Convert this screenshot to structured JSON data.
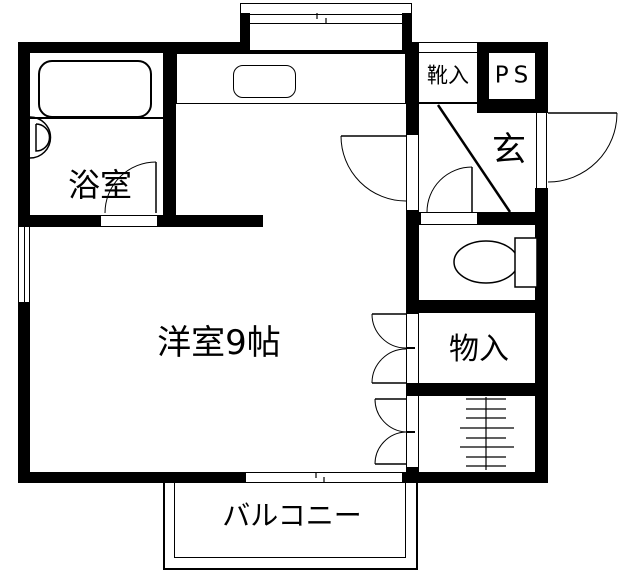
{
  "type": "floor-plan",
  "colors": {
    "wall": "#000000",
    "background": "#ffffff",
    "line": "#000000"
  },
  "rooms": {
    "bathroom": {
      "label": "浴室"
    },
    "main_room": {
      "label": "洋室9帖"
    },
    "entrance": {
      "label": "玄"
    },
    "shoe_cabinet": {
      "label": "靴入"
    },
    "pipe_space": {
      "label": "PS"
    },
    "storage": {
      "label": "物入"
    },
    "balcony": {
      "label": "バルコニー"
    }
  },
  "fixtures": [
    "bathtub",
    "washbasin",
    "bathroom-door",
    "kitchen-counter",
    "kitchen-sink",
    "sliding-window-top",
    "side-window-left",
    "sliding-window-bottom",
    "hall-door",
    "entrance-door",
    "genkan-step-diagonal",
    "toilet-door",
    "toilet-bowl",
    "toilet-tank",
    "storage-double-door",
    "closet-double-door",
    "ladder",
    "balcony-rail"
  ]
}
